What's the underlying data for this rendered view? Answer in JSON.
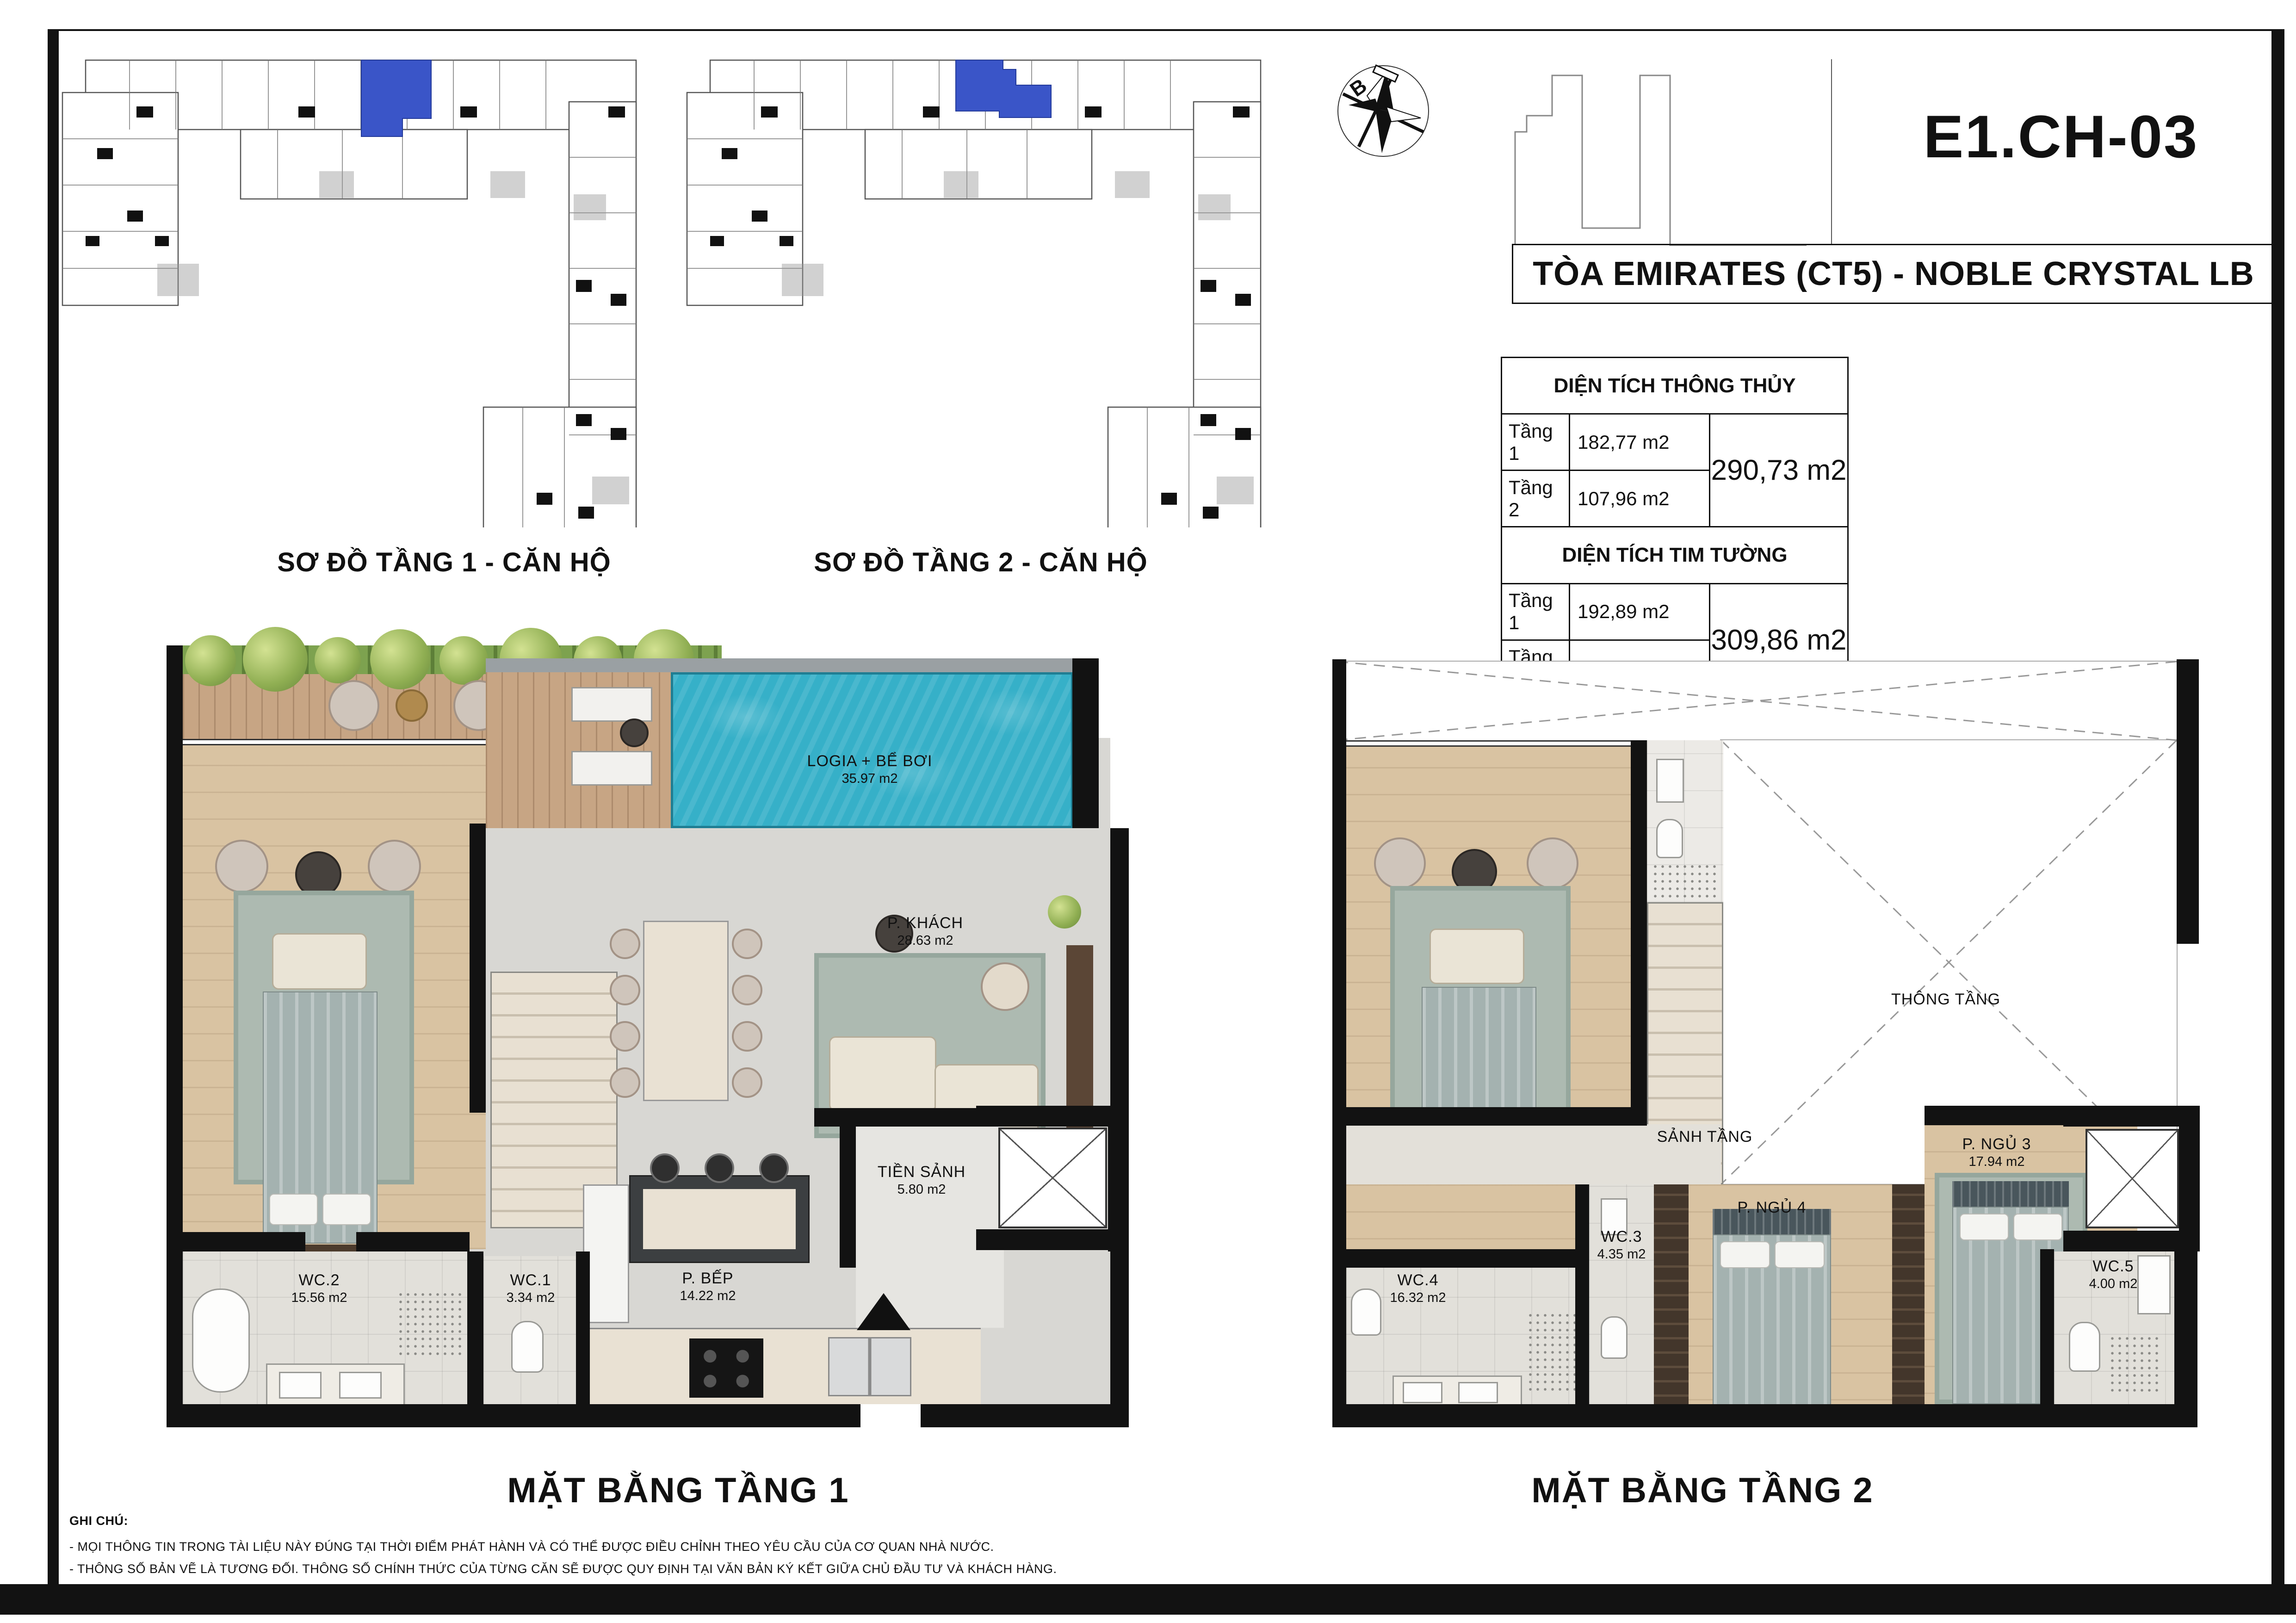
{
  "title_block": {
    "unit_code": "E1.CH-03",
    "building_name": "TÒA EMIRATES (CT5) - NOBLE CRYSTAL LB"
  },
  "compass": {
    "north_label": "B"
  },
  "site_plans": {
    "plan1_label": "SƠ ĐỒ TẦNG 1 - CĂN HỘ",
    "plan2_label": "SƠ ĐỒ TẦNG 2 - CĂN HỘ"
  },
  "area_table": {
    "section1": {
      "title": "DIỆN TÍCH THÔNG THỦY",
      "rows": [
        {
          "label": "Tầng 1",
          "value": "182,77 m2"
        },
        {
          "label": "Tầng 2",
          "value": "107,96 m2"
        }
      ],
      "total": "290,73 m2"
    },
    "section2": {
      "title": "DIỆN TÍCH TIM TƯỜNG",
      "rows": [
        {
          "label": "Tầng 1",
          "value": "192,89 m2"
        },
        {
          "label": "Tầng 2",
          "value": "117,00 m2"
        }
      ],
      "total": "309,86 m2"
    }
  },
  "floor1": {
    "title": "MẶT BẰNG TẦNG 1",
    "rooms": {
      "pool": {
        "name": "LOGIA + BỂ BƠI",
        "area": "35.97 m2"
      },
      "living": {
        "name": "P. KHÁCH",
        "area": "28.63 m2"
      },
      "foyer": {
        "name": "TIỀN SẢNH",
        "area": "5.80 m2"
      },
      "kitchen": {
        "name": "P. BẾP",
        "area": "14.22 m2"
      },
      "wc1": {
        "name": "WC.1",
        "area": "3.34 m2"
      },
      "wc2": {
        "name": "WC.2",
        "area": "15.56 m2"
      }
    }
  },
  "floor2": {
    "title": "MẶT BẰNG TẦNG 2",
    "rooms": {
      "void": {
        "name": "THÔNG TẦNG"
      },
      "hall": {
        "name": "SẢNH TẦNG"
      },
      "bed3": {
        "name": "P. NGỦ 3",
        "area": "17.94 m2"
      },
      "bed4": {
        "name": "P. NGỦ 4"
      },
      "wc3": {
        "name": "WC.3",
        "area": "4.35 m2"
      },
      "wc4": {
        "name": "WC.4",
        "area": "16.32 m2"
      },
      "wc5": {
        "name": "WC.5",
        "area": "4.00 m2"
      }
    }
  },
  "notes": {
    "heading": "GHI CHÚ:",
    "lines": [
      "- MỌI THÔNG TIN TRONG TÀI LIỆU NÀY ĐÚNG TẠI THỜI ĐIỂM PHÁT HÀNH VÀ CÓ THỂ ĐƯỢC ĐIỀU CHỈNH THEO YÊU CẦU CỦA CƠ QUAN NHÀ NƯỚC.",
      "- THÔNG SỐ BẢN VẼ LÀ TƯƠNG ĐỐI. THÔNG SỐ CHÍNH THỨC CỦA TỪNG CĂN SẼ ĐƯỢC QUY ĐỊNH TẠI VĂN BẢN KÝ KẾT GIỮA CHỦ ĐẦU TƯ VÀ KHÁCH HÀNG."
    ]
  },
  "colors": {
    "accent": "#3a55c8",
    "pool": "#36b0c8",
    "wood": "#d9c3a2",
    "deck": "#c7a584",
    "tile": "#d8d7d3",
    "tile_light": "#e2e0da",
    "marble": "#e9e1d3",
    "rug": "#adbab1",
    "wall": "#121212",
    "green": "#8aac55"
  }
}
